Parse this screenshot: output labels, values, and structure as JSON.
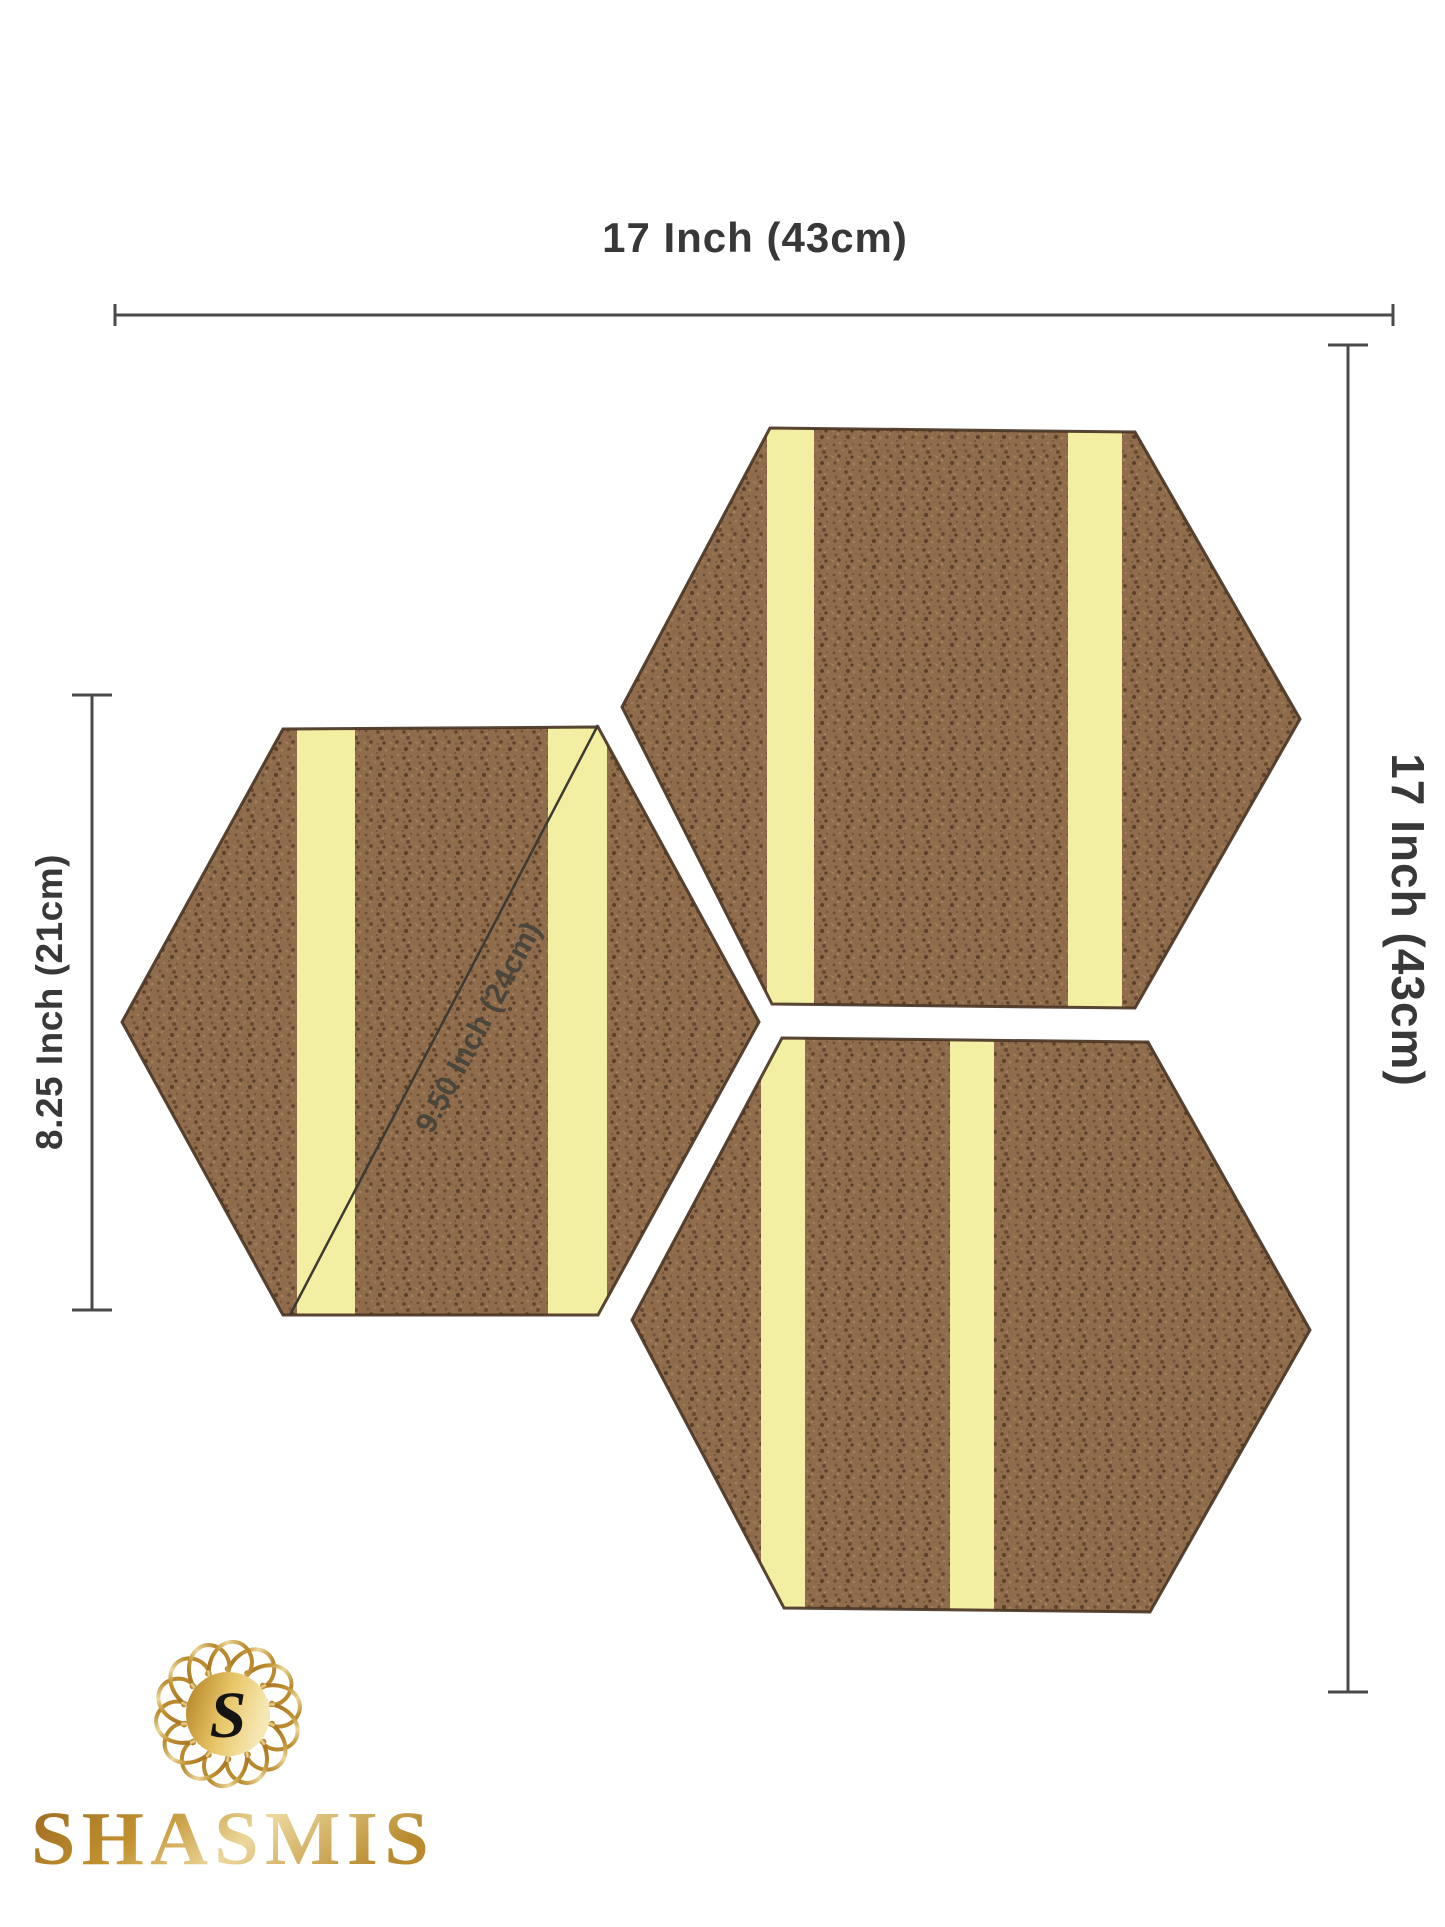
{
  "annotations": {
    "top_width": "17 Inch (43cm)",
    "right_height": "17 Inch (43cm)",
    "left_height": "8.25 Inch (21cm)",
    "diagonal": "9.50 Inch (24cm)"
  },
  "brand": {
    "wordmark": "SHASMIS",
    "monogram": "S"
  },
  "panels": {
    "count": 3,
    "shape": "hexagon",
    "strips_per_panel": 2
  },
  "colors": {
    "background": "#ffffff",
    "cork_base": "#8f6c4c",
    "cork_edge": "#4a3524",
    "adhesive_strip": "#f2efa2",
    "dimension_ink": "#3a3a3a",
    "gold_dark": "#9a671e",
    "gold_light": "#f5e6b0"
  }
}
